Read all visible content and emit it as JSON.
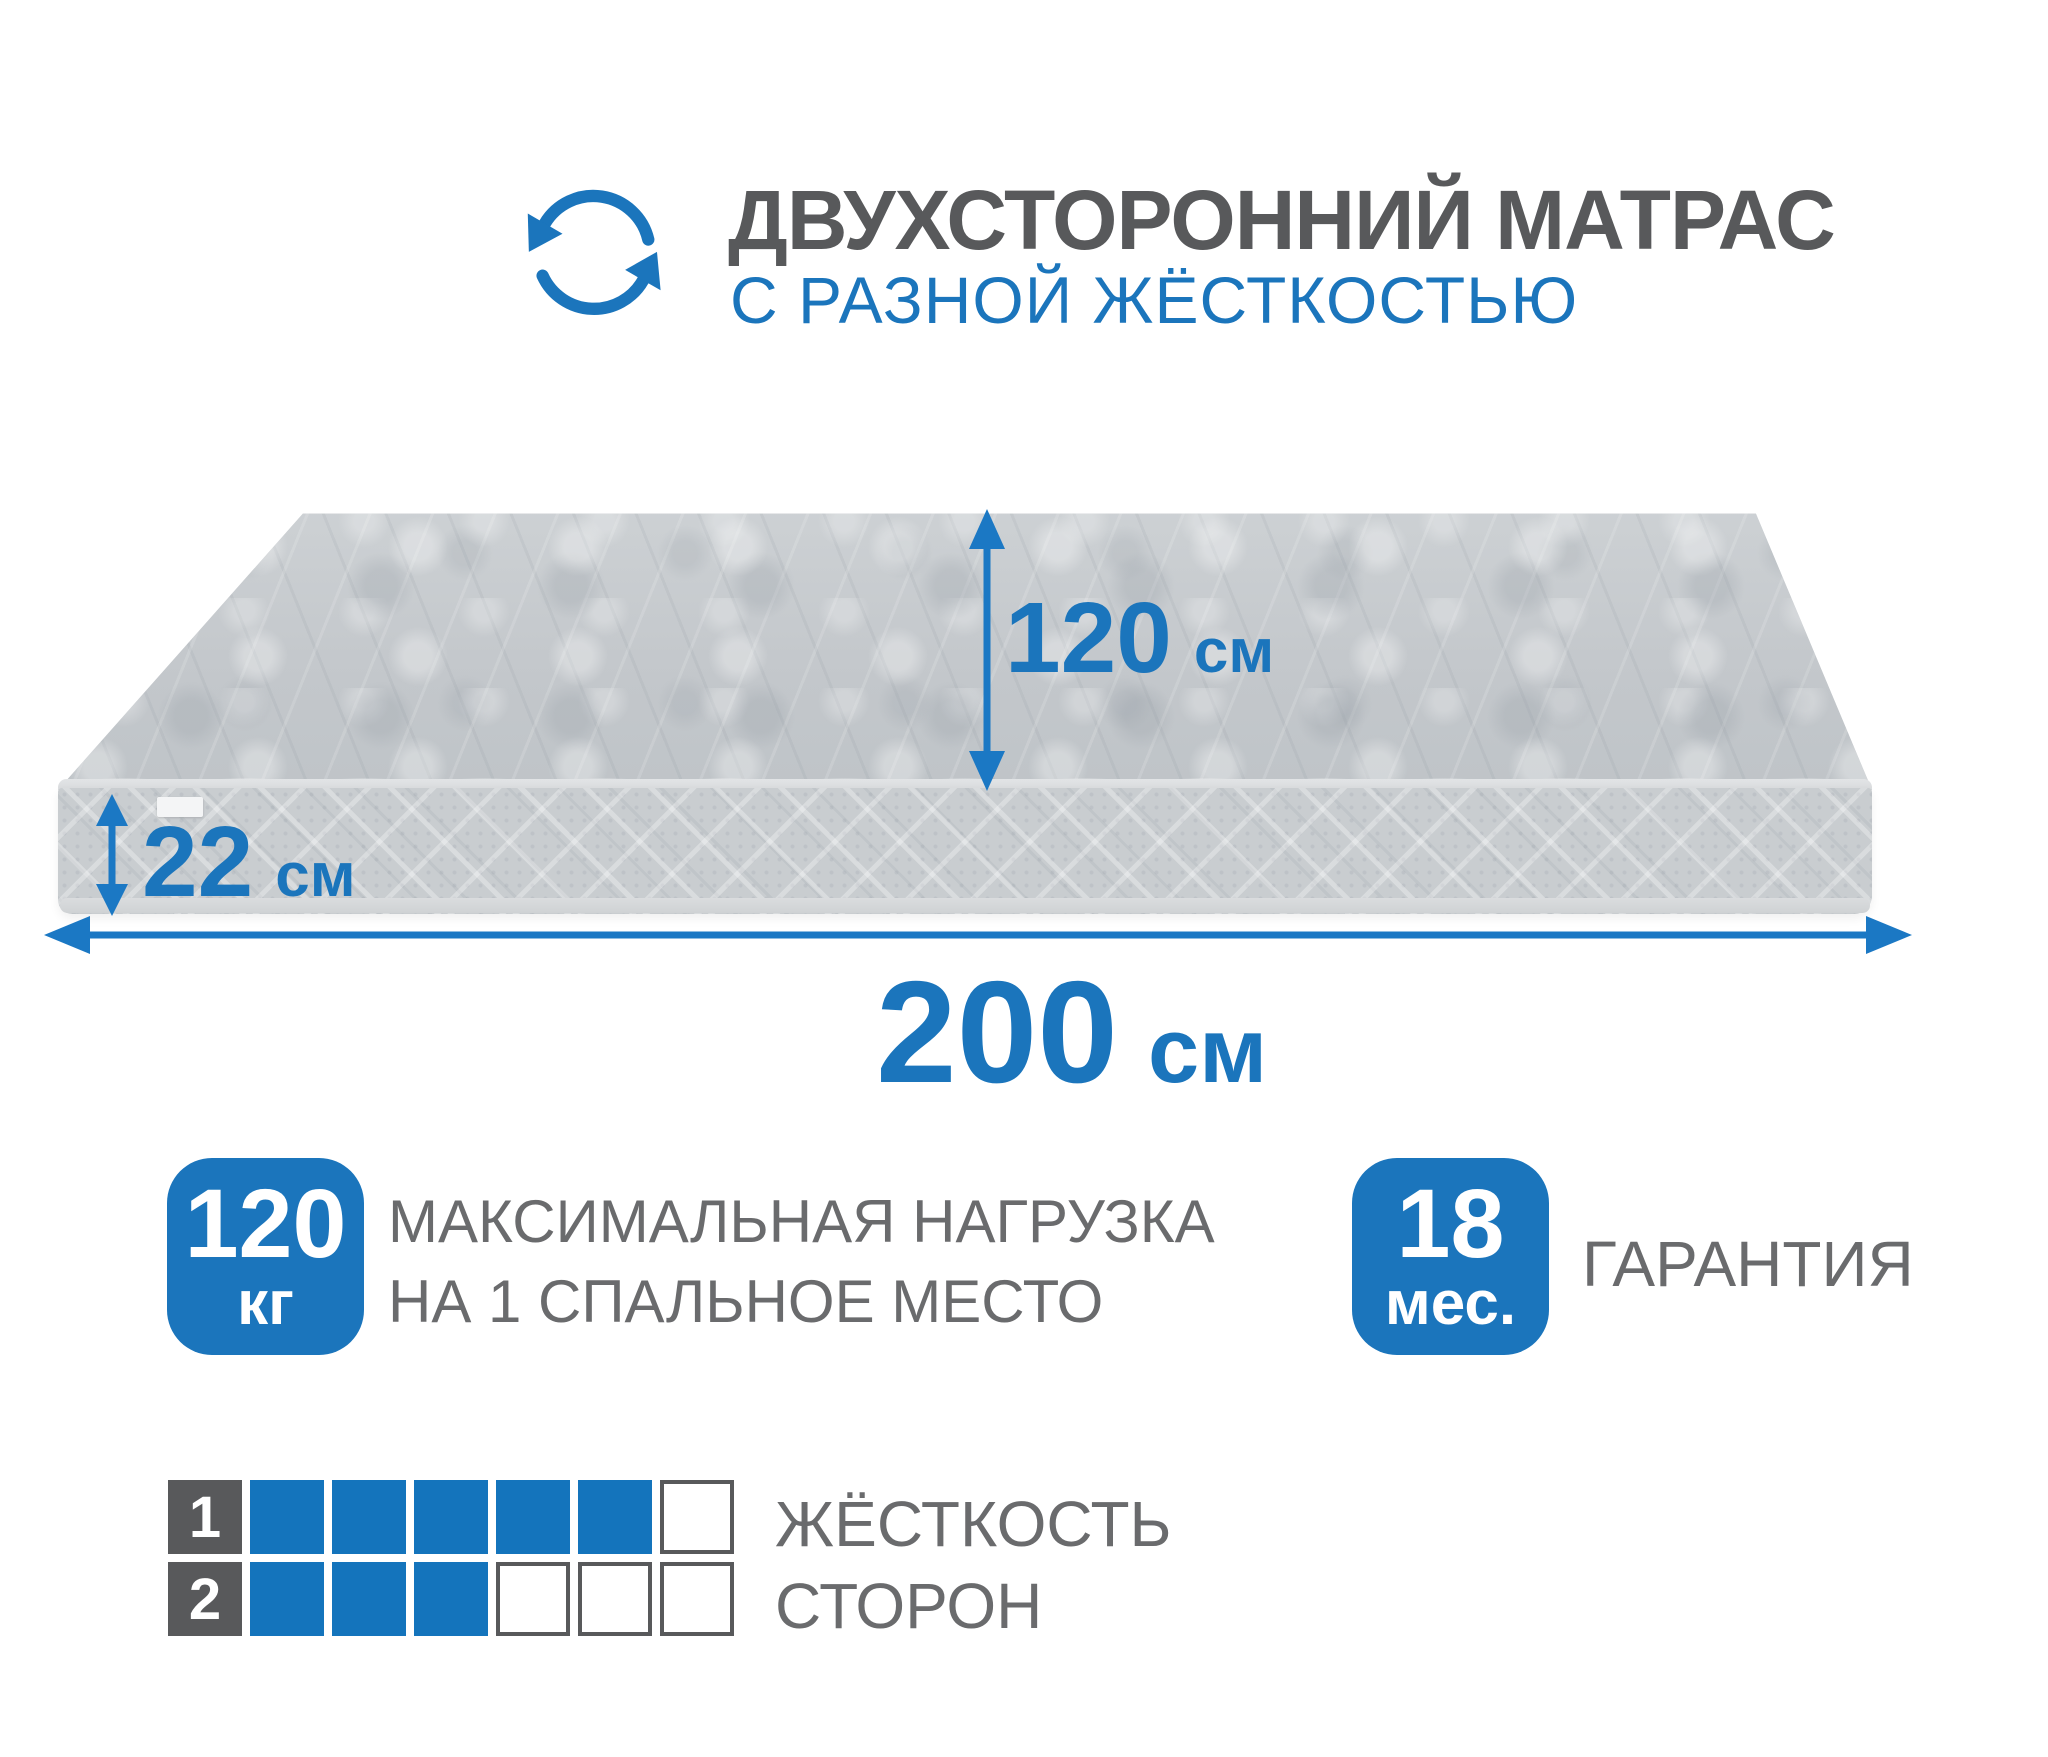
{
  "colors": {
    "accent": "#1b75bc",
    "solid_blue": "#1474bc",
    "title_gray": "#58595b",
    "label_gray": "#6a6b6d",
    "mattress_gray": "#c6cacd"
  },
  "header": {
    "icon": "rotate-arrows-icon",
    "title": "ДВУХСТОРОННИЙ МАТРАС",
    "subtitle": "С РАЗНОЙ ЖЁСТКОСТЬЮ"
  },
  "dimensions": {
    "width": {
      "value": "120",
      "unit": "см"
    },
    "height": {
      "value": "22",
      "unit": "см"
    },
    "length": {
      "value": "200",
      "unit": "см"
    }
  },
  "badges": {
    "max_load": {
      "value": "120",
      "unit": "кг",
      "caption_line1": "МАКСИМАЛЬНАЯ НАГРУЗКА",
      "caption_line2": "НА 1 СПАЛЬНОЕ МЕСТО"
    },
    "warranty": {
      "value": "18",
      "unit": "мес.",
      "caption": "ГАРАНТИЯ"
    }
  },
  "firmness": {
    "caption_line1": "ЖЁСТКОСТЬ",
    "caption_line2": "СТОРОН",
    "rows": [
      {
        "side": "1",
        "filled": 5,
        "total": 6
      },
      {
        "side": "2",
        "filled": 3,
        "total": 6
      }
    ]
  }
}
